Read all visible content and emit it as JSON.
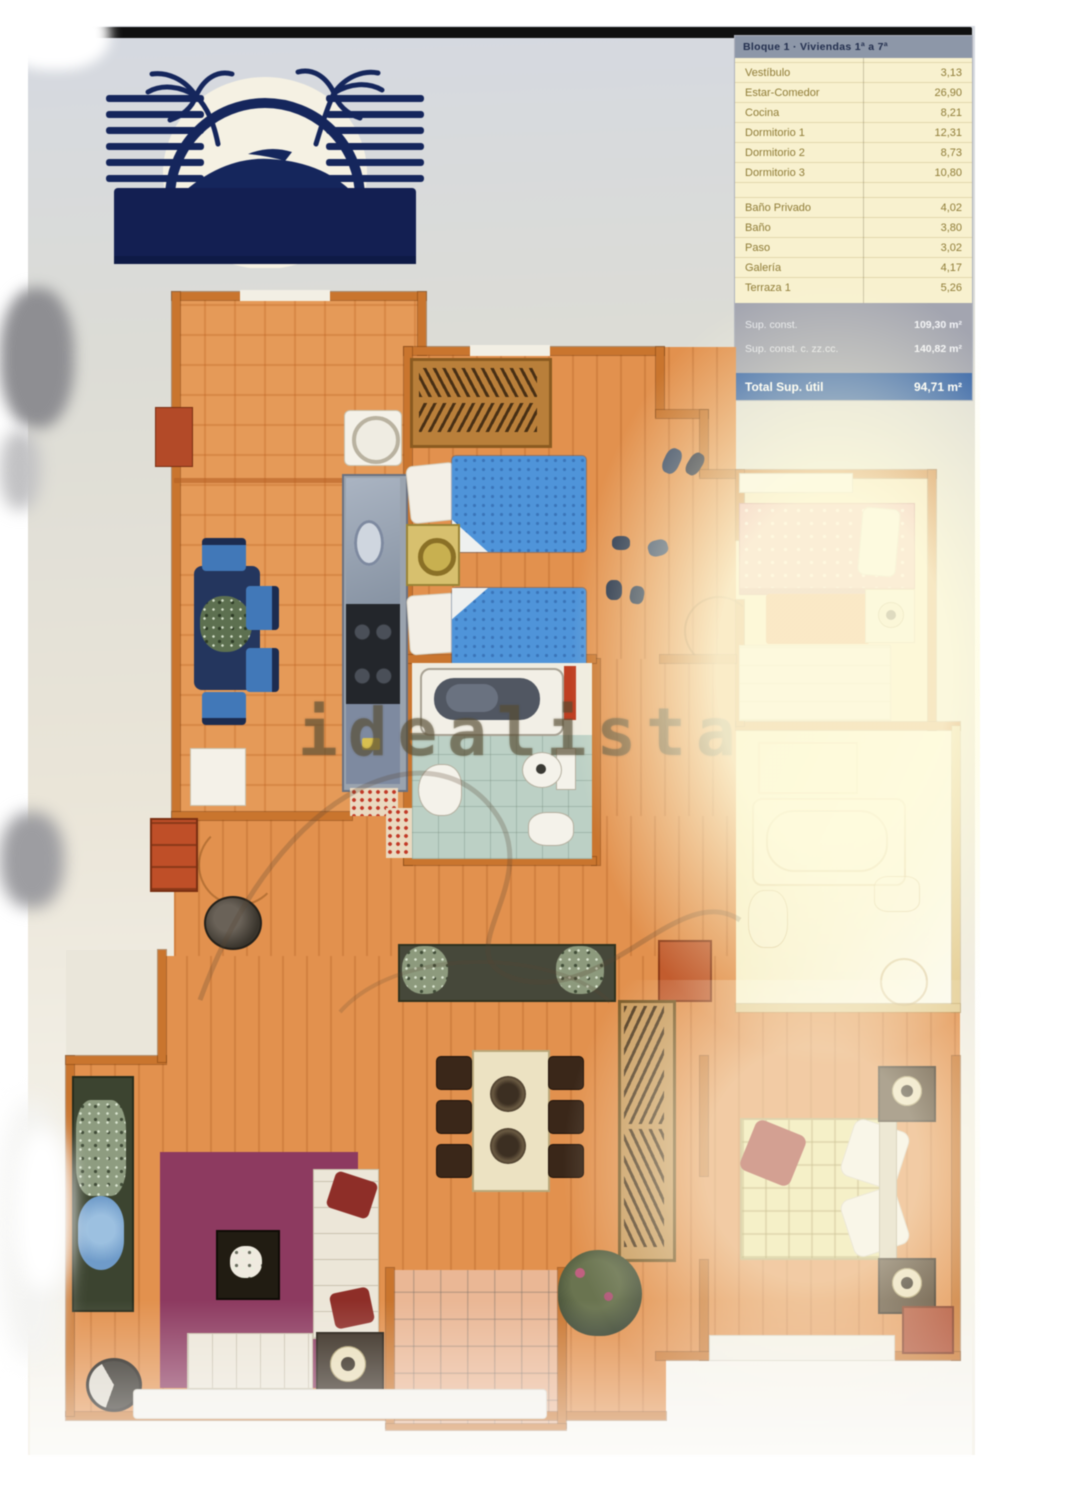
{
  "watermark": {
    "text": "idealista"
  },
  "logo": {
    "name": "seaside-residential-development-logo"
  },
  "area_table": {
    "header": "Bloque 1 · Viviendas 1ª a 7ª",
    "rows": [
      {
        "label": "Vestíbulo",
        "value": "3,13"
      },
      {
        "label": "Estar-Comedor",
        "value": "26,90"
      },
      {
        "label": "Cocina",
        "value": "8,21"
      },
      {
        "label": "Dormitorio 1",
        "value": "12,31"
      },
      {
        "label": "Dormitorio 2",
        "value": "8,73"
      },
      {
        "label": "Dormitorio 3",
        "value": "10,80"
      },
      {
        "label": "Baño Privado",
        "value": "4,02"
      },
      {
        "label": "Baño",
        "value": "3,80"
      },
      {
        "label": "Paso",
        "value": "3,02"
      },
      {
        "label": "Galería",
        "value": "4,17"
      },
      {
        "label": "Terraza 1",
        "value": "5,26"
      }
    ],
    "summary": [
      {
        "label": "Sup. const.",
        "value": "109,30 m²"
      },
      {
        "label": "Sup. const. c. zz.cc.",
        "value": "140,82 m²"
      }
    ],
    "total": {
      "label": "Total Sup. útil",
      "value": "94,71 m²"
    }
  },
  "colors": {
    "accent_blue": "#2f5fa6",
    "plan_wood": "#e2914e",
    "table_cream": "#f8f1cf"
  }
}
